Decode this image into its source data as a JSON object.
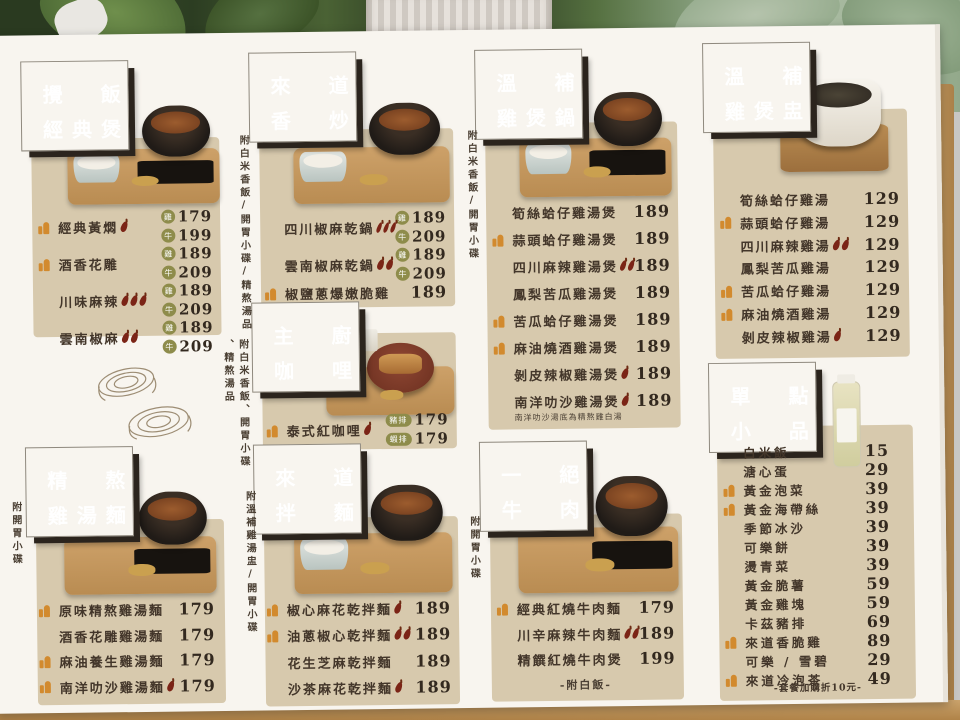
{
  "colors": {
    "header_bg": "#2b241d",
    "panel_beige": "#d7c9ad",
    "thumb_orange": "#d28a2e",
    "chili_red": "#7b2416",
    "badge_olive": "#8e8c4b",
    "board_white": "#f8f5ef"
  },
  "icons": {
    "recommended": "thumbs-up-icon",
    "spicy": "chili-icon"
  },
  "notes": {
    "n1": "附白米香飯/開胃小碟/精熬湯品",
    "n2a": "附白米香飯、開胃小碟",
    "n2b": "、精熬湯品",
    "n3": "附白米香飯/開胃小碟",
    "n4": "附開胃小碟",
    "n5": "附溫補雞湯盅/開胃小碟",
    "n6": "附開胃小碟"
  },
  "s1": {
    "name": "攪飯經典煲",
    "t1": "攪飯",
    "t2": "經典煲",
    "items": [
      {
        "name": "經典黃燜",
        "recommended": true,
        "spice": 1,
        "tag1": "雞",
        "price1": "179",
        "tag2": "牛",
        "price2": "199"
      },
      {
        "name": "酒香花雕",
        "recommended": true,
        "spice": 0,
        "tag1": "雞",
        "price1": "189",
        "tag2": "牛",
        "price2": "209"
      },
      {
        "name": "川味麻辣",
        "recommended": false,
        "spice": 3,
        "tag1": "雞",
        "price1": "189",
        "tag2": "牛",
        "price2": "209"
      },
      {
        "name": "雲南椒麻",
        "recommended": false,
        "spice": 2,
        "tag1": "雞",
        "price1": "189",
        "tag2": "牛",
        "price2": "209"
      }
    ]
  },
  "s2": {
    "name": "來道香炒",
    "t1": "來道",
    "t2": "香炒",
    "items": [
      {
        "name": "四川椒麻乾鍋",
        "recommended": false,
        "spice": 3,
        "tag1": "雞",
        "price1": "189",
        "tag2": "牛",
        "price2": "209"
      },
      {
        "name": "雲南椒麻乾鍋",
        "recommended": false,
        "spice": 2,
        "tag1": "雞",
        "price1": "189",
        "tag2": "牛",
        "price2": "209"
      },
      {
        "name": "椒鹽蔥爆嫩脆雞",
        "recommended": true,
        "spice": 0,
        "price": "189"
      }
    ]
  },
  "s3": {
    "name": "主廚咖哩",
    "t1": "主廚",
    "t2": "咖哩",
    "items": [
      {
        "name": "泰式紅咖哩",
        "recommended": true,
        "spice": 1,
        "tag1": "豬排",
        "price1": "179",
        "tag2": "蝦排",
        "price2": "179"
      }
    ]
  },
  "s4": {
    "name": "溫補雞煲鍋",
    "t1": "溫補",
    "t2": "雞煲鍋",
    "items": [
      {
        "name": "筍絲蛤仔雞湯煲",
        "recommended": false,
        "spice": 0,
        "price": "189"
      },
      {
        "name": "蒜頭蛤仔雞湯煲",
        "recommended": true,
        "spice": 0,
        "price": "189"
      },
      {
        "name": "四川麻辣雞湯煲",
        "recommended": false,
        "spice": 2,
        "price": "189"
      },
      {
        "name": "鳳梨苦瓜雞湯煲",
        "recommended": false,
        "spice": 0,
        "price": "189"
      },
      {
        "name": "苦瓜蛤仔雞湯煲",
        "recommended": true,
        "spice": 0,
        "price": "189"
      },
      {
        "name": "麻油燒酒雞湯煲",
        "recommended": true,
        "spice": 0,
        "price": "189"
      },
      {
        "name": "剝皮辣椒雞湯煲",
        "recommended": false,
        "spice": 1,
        "price": "189"
      },
      {
        "name": "南洋叻沙雞湯煲",
        "recommended": false,
        "spice": 1,
        "price": "189",
        "note": "南洋叻沙湯底為精熬雞白湯"
      }
    ]
  },
  "s5": {
    "name": "溫補雞煲盅",
    "t1": "溫補",
    "t2": "雞煲盅",
    "items": [
      {
        "name": "筍絲蛤仔雞湯",
        "recommended": false,
        "spice": 0,
        "price": "129"
      },
      {
        "name": "蒜頭蛤仔雞湯",
        "recommended": true,
        "spice": 0,
        "price": "129"
      },
      {
        "name": "四川麻辣雞湯",
        "recommended": false,
        "spice": 2,
        "price": "129"
      },
      {
        "name": "鳳梨苦瓜雞湯",
        "recommended": false,
        "spice": 0,
        "price": "129"
      },
      {
        "name": "苦瓜蛤仔雞湯",
        "recommended": true,
        "spice": 0,
        "price": "129"
      },
      {
        "name": "麻油燒酒雞湯",
        "recommended": true,
        "spice": 0,
        "price": "129"
      },
      {
        "name": "剝皮辣椒雞湯",
        "recommended": false,
        "spice": 1,
        "price": "129"
      }
    ]
  },
  "s6": {
    "name": "單點小品",
    "t1": "單點",
    "t2": "小品",
    "footer": "-套餐加購折10元-",
    "items": [
      {
        "name": "白米飯",
        "recommended": false,
        "price": "15"
      },
      {
        "name": "溏心蛋",
        "recommended": false,
        "price": "29"
      },
      {
        "name": "黃金泡菜",
        "recommended": true,
        "price": "39"
      },
      {
        "name": "黃金海帶絲",
        "recommended": true,
        "price": "39"
      },
      {
        "name": "季節冰沙",
        "recommended": false,
        "price": "39"
      },
      {
        "name": "可樂餅",
        "recommended": false,
        "price": "39"
      },
      {
        "name": "燙青菜",
        "recommended": false,
        "price": "39"
      },
      {
        "name": "黃金脆薯",
        "recommended": false,
        "price": "59"
      },
      {
        "name": "黃金雞塊",
        "recommended": false,
        "price": "59"
      },
      {
        "name": "卡茲豬排",
        "recommended": false,
        "price": "69"
      },
      {
        "name": "來道香脆雞",
        "recommended": true,
        "price": "89"
      },
      {
        "name": "可樂 / 雪碧",
        "recommended": false,
        "price": "29"
      },
      {
        "name": "來道冷泡茶",
        "recommended": true,
        "price": "49"
      }
    ]
  },
  "s7": {
    "name": "精熬雞湯麵",
    "t1": "精熬",
    "t2": "雞湯麵",
    "items": [
      {
        "name": "原味精熬雞湯麵",
        "recommended": true,
        "spice": 0,
        "price": "179"
      },
      {
        "name": "酒香花雕雞湯麵",
        "recommended": false,
        "spice": 0,
        "price": "179"
      },
      {
        "name": "麻油養生雞湯麵",
        "recommended": true,
        "spice": 0,
        "price": "179"
      },
      {
        "name": "南洋叻沙雞湯麵",
        "recommended": true,
        "spice": 1,
        "price": "179"
      }
    ]
  },
  "s8": {
    "name": "來道拌麵",
    "t1": "來道",
    "t2": "拌麵",
    "items": [
      {
        "name": "椒心麻花乾拌麵",
        "recommended": true,
        "spice": 1,
        "price": "189"
      },
      {
        "name": "油蔥椒心乾拌麵",
        "recommended": true,
        "spice": 2,
        "price": "189"
      },
      {
        "name": "花生芝麻乾拌麵",
        "recommended": false,
        "spice": 0,
        "price": "189"
      },
      {
        "name": "沙茶麻花乾拌麵",
        "recommended": false,
        "spice": 1,
        "price": "189"
      }
    ]
  },
  "s9": {
    "name": "一絕牛肉",
    "t1": "一絕",
    "t2": "牛肉",
    "items": [
      {
        "name": "經典紅燒牛肉麵",
        "recommended": true,
        "spice": 0,
        "price": "179"
      },
      {
        "name": "川辛麻辣牛肉麵",
        "recommended": false,
        "spice": 2,
        "price": "189"
      },
      {
        "name": "精饌紅燒牛肉煲",
        "recommended": false,
        "spice": 0,
        "price": "199",
        "note": "-附白飯-"
      }
    ]
  }
}
